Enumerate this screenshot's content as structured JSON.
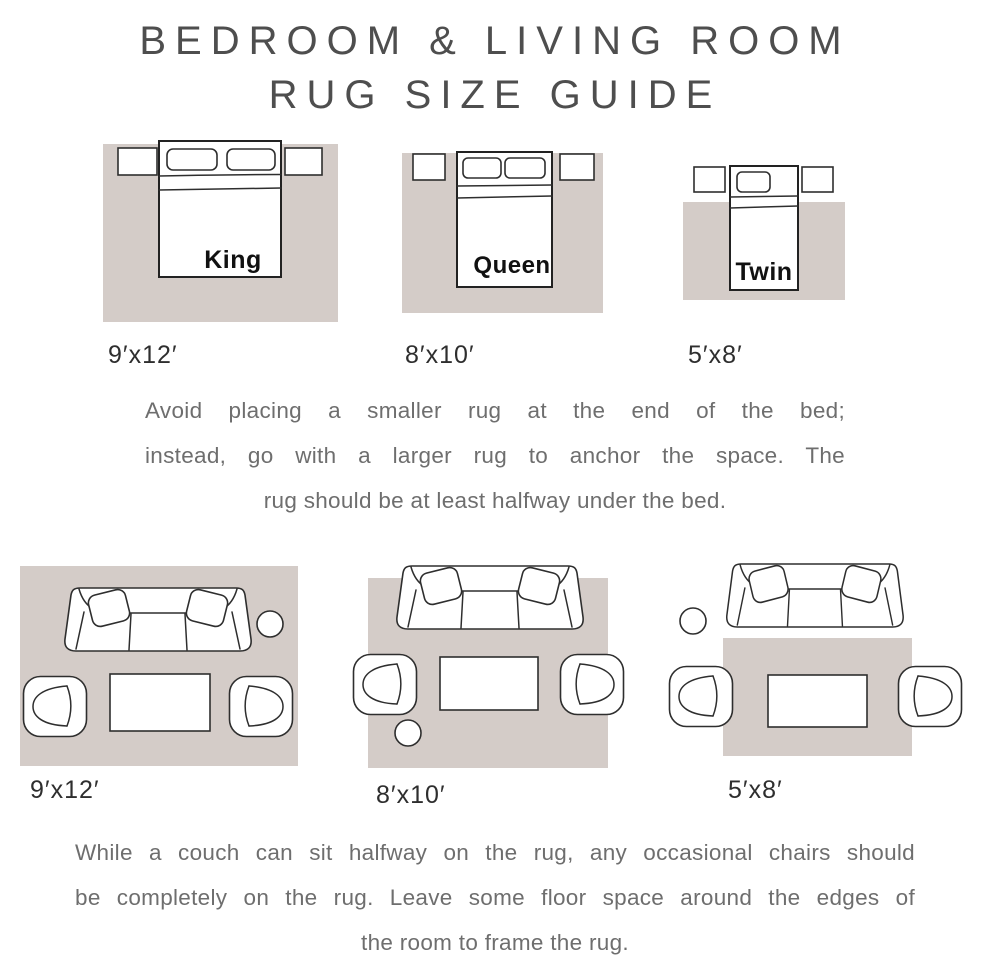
{
  "title": {
    "line1": "BEDROOM & LIVING ROOM",
    "line2": "RUG SIZE GUIDE"
  },
  "colors": {
    "rug": "#d4ccc8",
    "furniture_fill": "#ffffff",
    "furniture_outline": "#2e2e2e",
    "title_text": "#4e4e4e",
    "body_text": "#6e6e6e",
    "size_label_text": "#2e2e2e",
    "bed_label_text": "#111111"
  },
  "bedroom_section": {
    "diagrams": [
      {
        "bed_label": "King",
        "rug_size": "9′x12′",
        "furniture": [
          "nightstand",
          "bed",
          "nightstand"
        ]
      },
      {
        "bed_label": "Queen",
        "rug_size": "8′x10′",
        "furniture": [
          "nightstand",
          "bed",
          "nightstand"
        ]
      },
      {
        "bed_label": "Twin",
        "rug_size": "5′x8′",
        "furniture": [
          "nightstand",
          "bed",
          "nightstand"
        ]
      }
    ],
    "note_lines": [
      "Avoid placing a smaller rug at the end of the bed;",
      "instead, go with a larger rug to anchor the space. The",
      "rug should be at least halfway under the bed."
    ]
  },
  "living_room_section": {
    "diagrams": [
      {
        "rug_size": "9′x12′",
        "furniture": [
          "sofa",
          "side-table",
          "armchair",
          "coffee-table",
          "armchair"
        ]
      },
      {
        "rug_size": "8′x10′",
        "furniture": [
          "sofa",
          "armchair",
          "coffee-table",
          "armchair",
          "side-table"
        ]
      },
      {
        "rug_size": "5′x8′",
        "furniture": [
          "side-table",
          "sofa",
          "armchair",
          "coffee-table",
          "armchair"
        ]
      }
    ],
    "note_lines": [
      "While a couch can sit halfway on the rug, any occasional chairs should",
      "be completely on the rug. Leave some floor space around the edges of",
      "the room to frame the rug."
    ]
  }
}
